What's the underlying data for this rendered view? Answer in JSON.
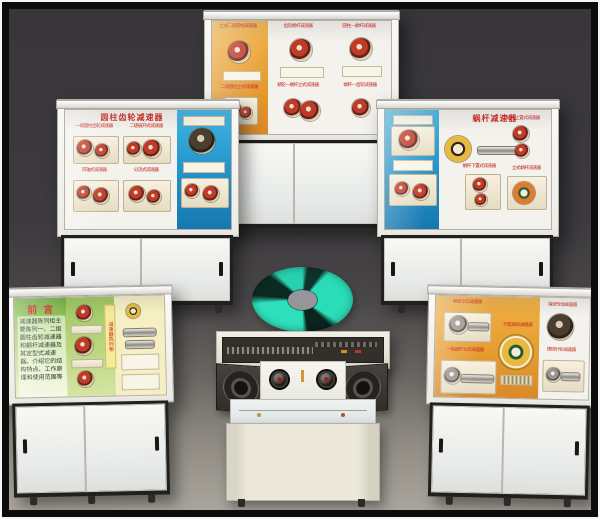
{
  "colors": {
    "wall": "#3b393c",
    "floor": "#a29e95",
    "panel_orange": "#e8a035",
    "panel_blue": "#2a9fd2",
    "panel_green": "#7ab648",
    "panel_yellow": "#f5efc2",
    "label_red": "#c8241e",
    "cd_teal": "#2bd4b4"
  },
  "cabinets": {
    "top_center": {
      "labels_top": [
        "立式二级圆柱减速器",
        "齿轮蜗杆减速器",
        "圆柱—蜗杆减速器"
      ],
      "labels_mid": [
        "二级圆柱立式减速器",
        "蜗轮—蜗杆立式减速器",
        "蜗杆—齿轮减速器"
      ]
    },
    "upper_left": {
      "title": "圆柱齿轮减速器",
      "labels": [
        "一级圆柱齿轮减速器",
        "二级展开式减速器",
        "同轴式减速器",
        "分流式减速器"
      ]
    },
    "upper_right": {
      "title": "蜗杆减速器",
      "labels": [
        "蜗杆上置式减速器",
        "蜗杆下置式减速器",
        "立式蜗杆减速器"
      ]
    },
    "lower_left": {
      "title": "前言",
      "body": "减速器陈列柜主要陈列一、二级圆柱齿轮减速器和蜗杆减速器及其定型式减速器。介绍它的结构特点、工作原理和使用范围等",
      "strip_label": "减速器陈列柜"
    },
    "lower_right": {
      "labels": [
        "单级立式减速器",
        "一级蜗杆立式减速器",
        "行星齿轮减速器",
        "谐波传动减速器",
        "摆线针轮减速器"
      ]
    }
  }
}
